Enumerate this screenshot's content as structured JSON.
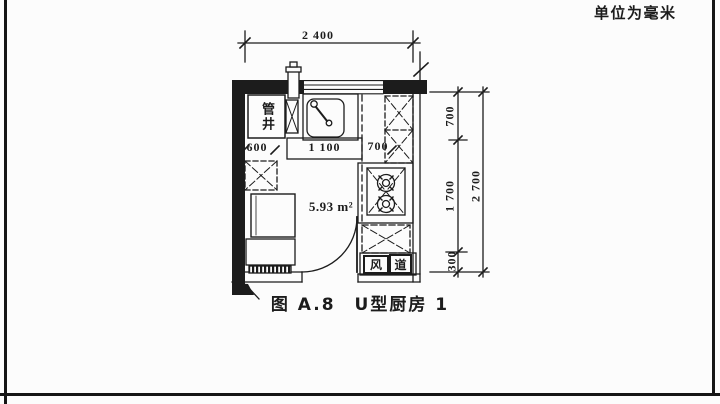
{
  "meta": {
    "unit_note": "单位为毫米",
    "caption": "图 A.8　U型厨房 1"
  },
  "plan": {
    "area_label": "5.93 m²",
    "labels": {
      "pipe_shaft": "管井",
      "duct_char_1": "风",
      "duct_char_2": "道"
    },
    "dimensions": {
      "top_width": "2 400",
      "inner_left": "600",
      "inner_middle": "1 100",
      "inner_right": "700",
      "right_top": "700",
      "right_middle": "1 700",
      "right_bottom": "300",
      "right_total": "2 700"
    }
  },
  "colors": {
    "ink": "#1c1c1c",
    "paper": "#fcfcfc"
  }
}
